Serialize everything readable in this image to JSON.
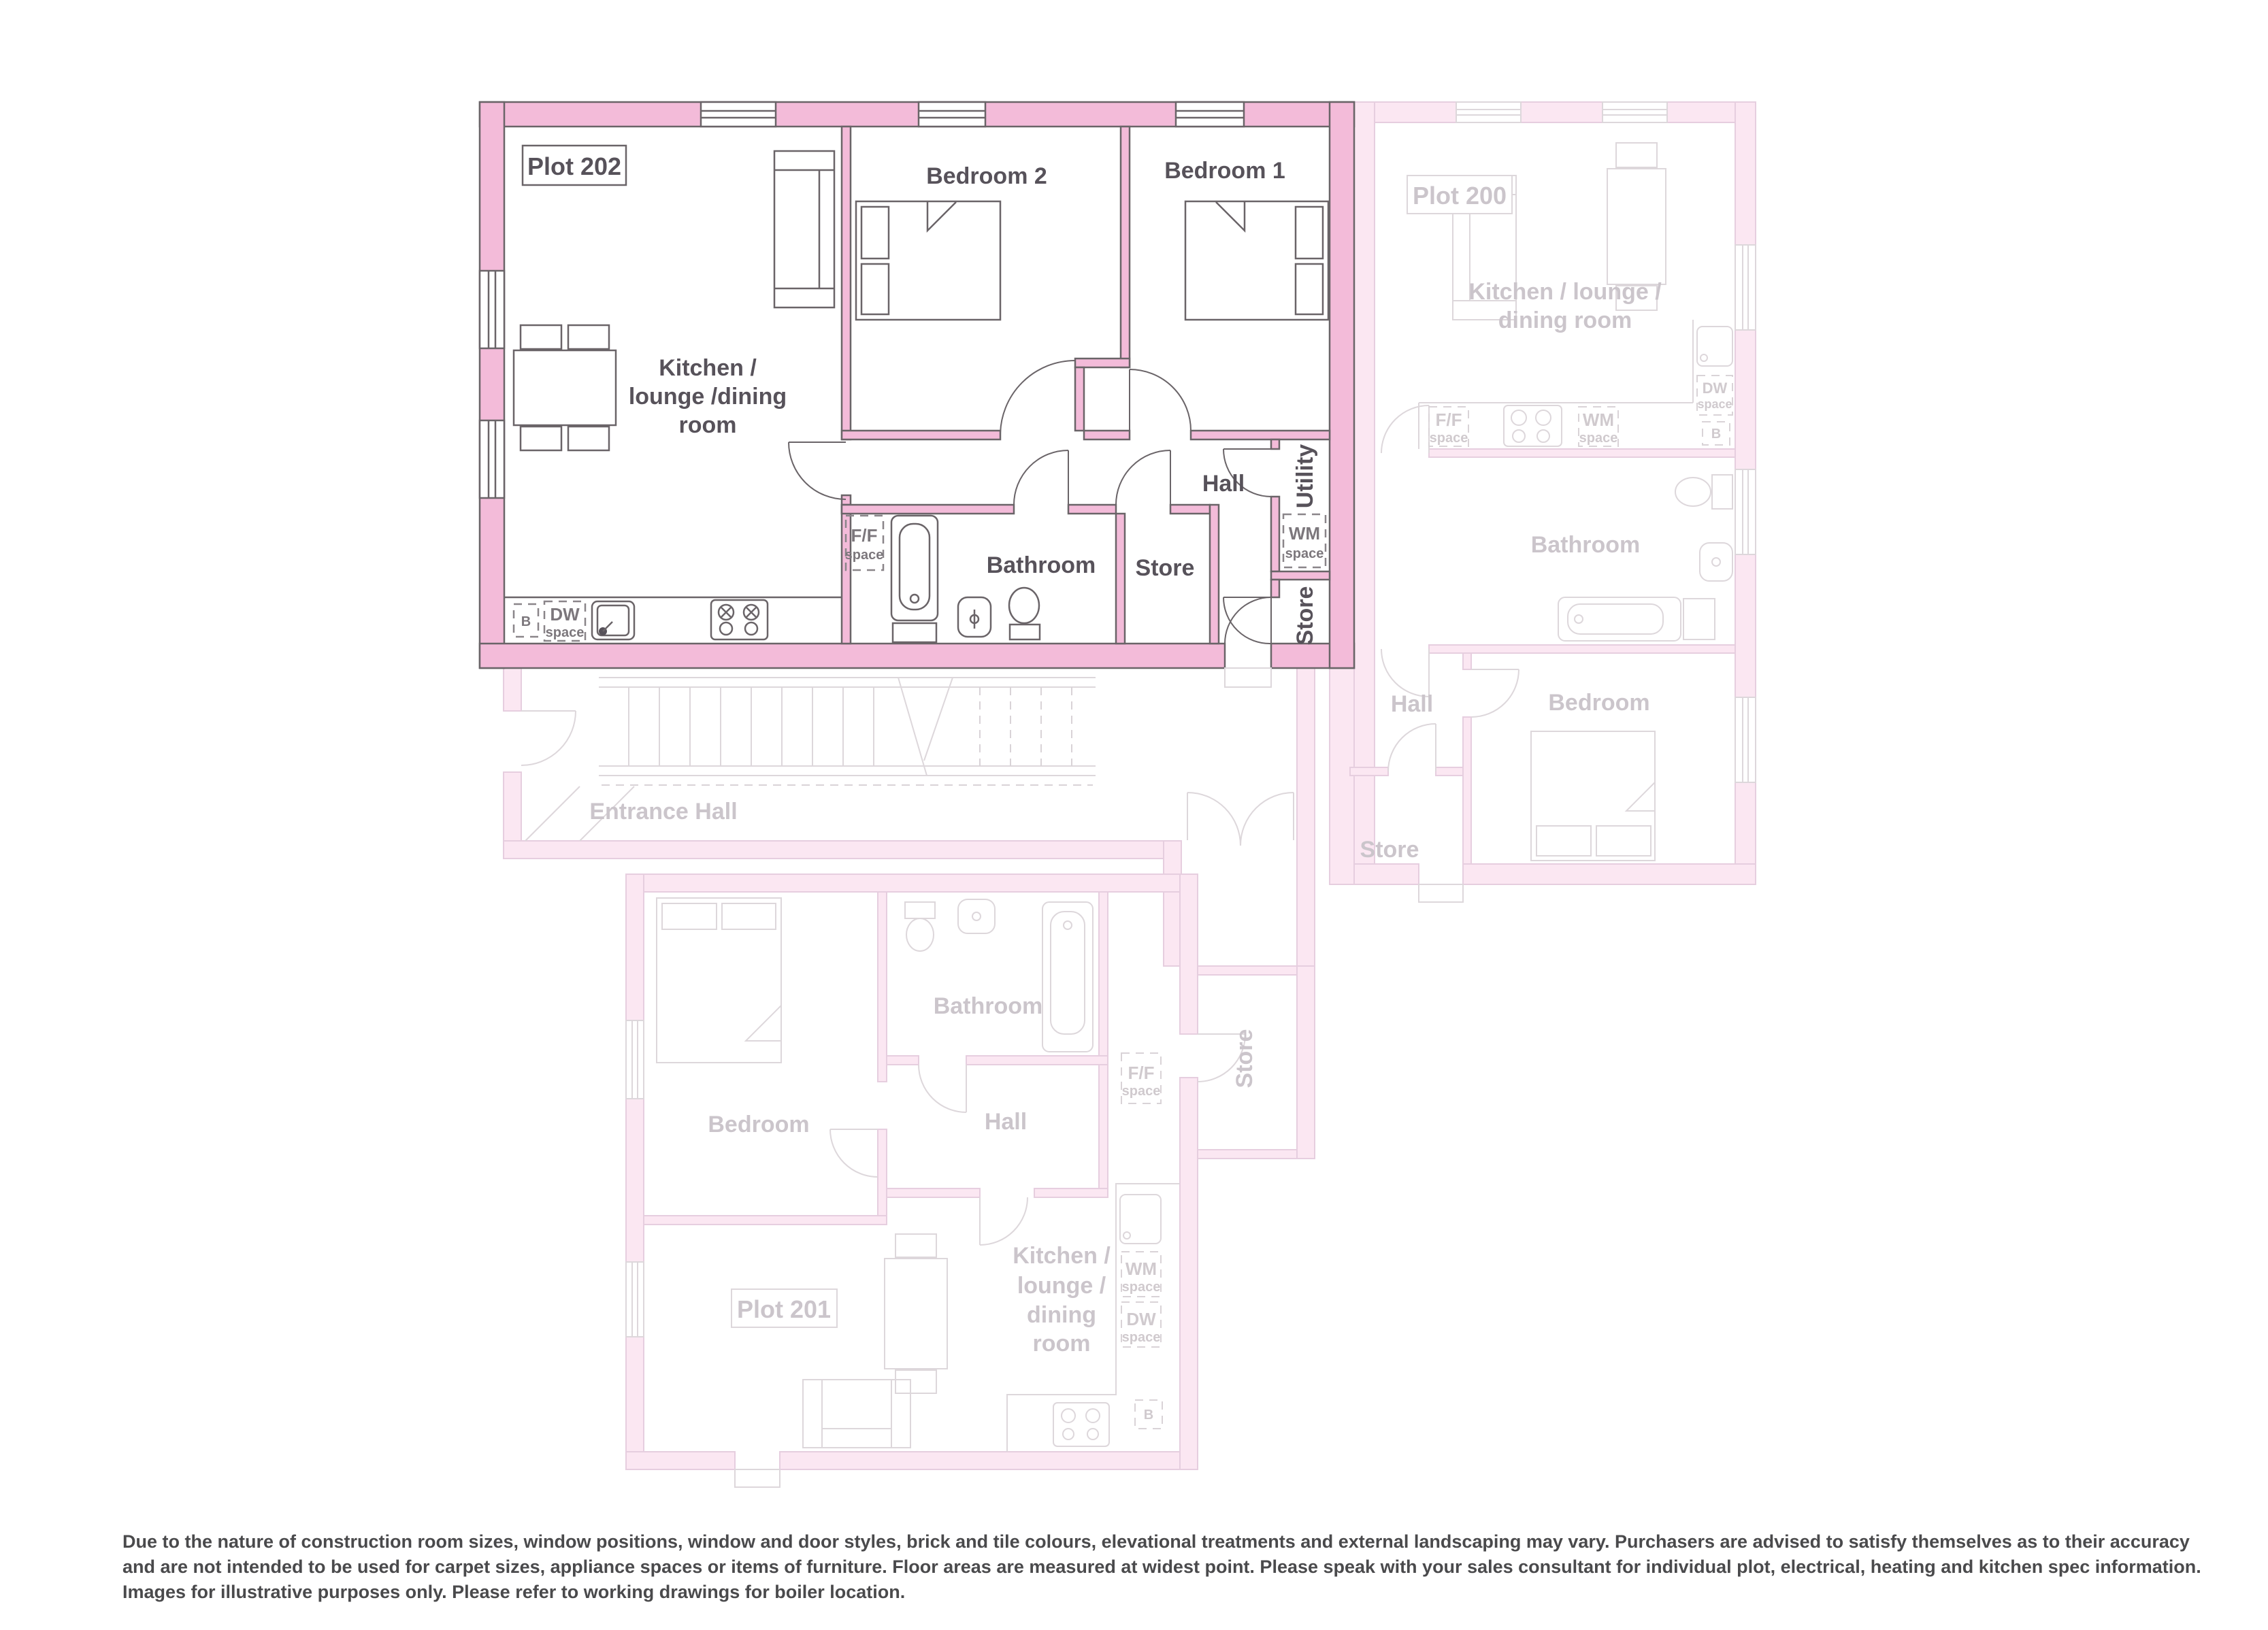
{
  "colors": {
    "active_wall": "#F3BBD9",
    "active_line": "#6A6468",
    "active_text": "#57525A",
    "faded_wall": "#FBE7F2",
    "faded_line": "#E6CEDF",
    "faded_furniture": "#DDD7DB",
    "faded_text": "#CBC5CB",
    "background": "#FFFFFF"
  },
  "shared": {
    "ff1": "F/F",
    "ff2": "space",
    "wm1": "WM",
    "wm2": "space",
    "dw1": "DW",
    "dw2": "space",
    "boiler": "B"
  },
  "plots": {
    "p202": {
      "name": "Plot 202",
      "state": "highlighted",
      "rooms": {
        "kitchen1": "Kitchen /",
        "kitchen2": "lounge /dining",
        "kitchen3": "room",
        "bedroom2": "Bedroom 2",
        "bedroom1": "Bedroom 1",
        "hall": "Hall",
        "utility": "Utility",
        "bathroom": "Bathroom",
        "store": "Store",
        "store2": "Store"
      }
    },
    "p200": {
      "name": "Plot 200",
      "state": "faded",
      "rooms": {
        "kitchen1": "Kitchen / lounge /",
        "kitchen2": "dining room",
        "bathroom": "Bathroom",
        "hall": "Hall",
        "bedroom": "Bedroom",
        "store": "Store"
      }
    },
    "p201": {
      "name": "Plot 201",
      "state": "faded",
      "rooms": {
        "kitchen1": "Kitchen /",
        "kitchen2": "lounge /",
        "kitchen3": "dining",
        "kitchen4": "room",
        "bedroom": "Bedroom",
        "bathroom": "Bathroom",
        "hall": "Hall",
        "store": "Store"
      }
    }
  },
  "entrance_hall": {
    "label": "Entrance Hall"
  },
  "disclaimer": "Due to the nature of construction room sizes, window positions, window and door styles, brick and tile colours, elevational treatments and external landscaping may vary. Purchasers are advised to satisfy themselves as to their accuracy and are not intended to be used for carpet sizes, appliance spaces or items of furniture. Floor areas are measured at widest point. Please speak with your sales consultant for individual plot, electrical, heating and kitchen spec information. Images for illustrative purposes only. Please refer to working drawings for boiler location."
}
